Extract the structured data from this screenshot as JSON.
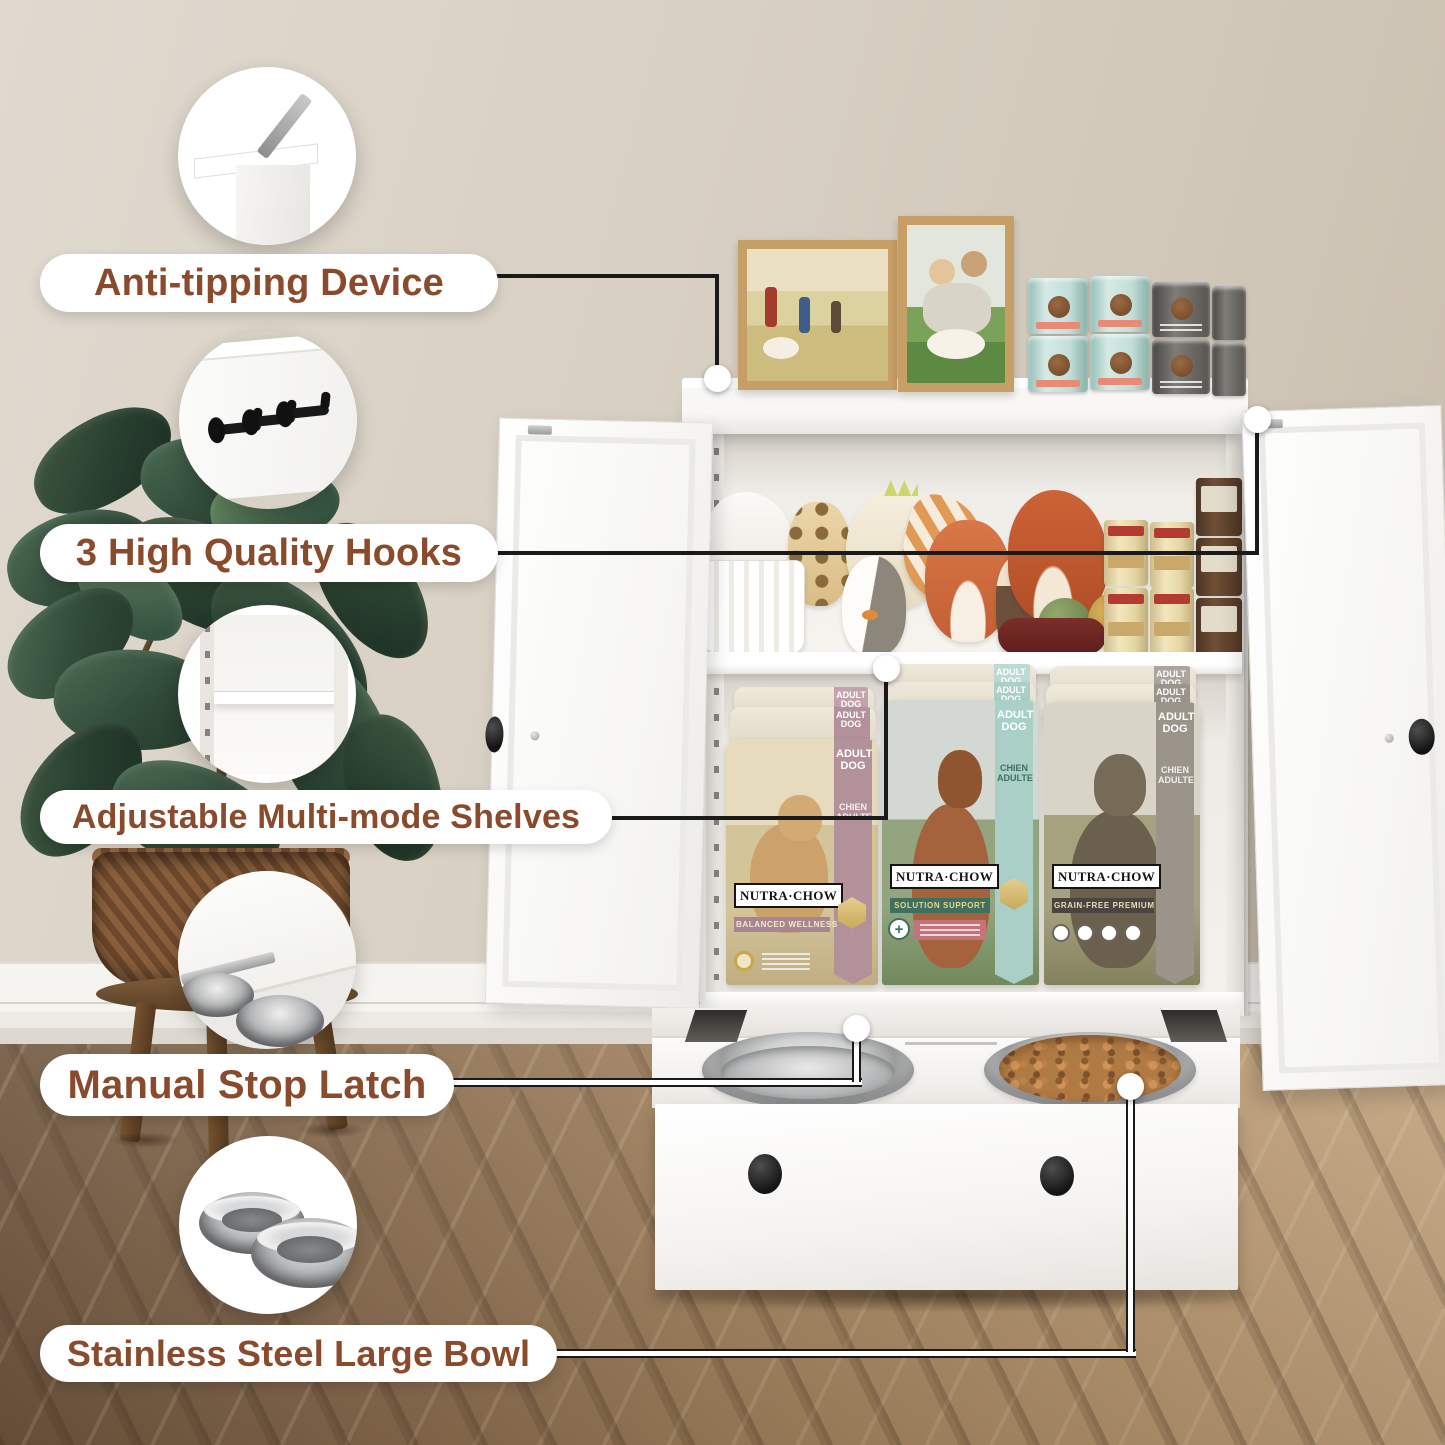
{
  "callouts": [
    {
      "label": "Anti-tipping Device",
      "icon": "anti-tip-bracket-icon"
    },
    {
      "label": "3 High Quality Hooks",
      "icon": "three-hooks-icon"
    },
    {
      "label": "Adjustable Multi-mode Shelves",
      "icon": "adjustable-shelf-icon"
    },
    {
      "label": "Manual Stop Latch",
      "icon": "manual-stop-latch-icon"
    },
    {
      "label": "Stainless Steel Large Bowl",
      "icon": "stainless-bowls-icon"
    }
  ],
  "products": {
    "bags": [
      {
        "brand": "NUTRA·CHOW",
        "line": "BALANCED WELLNESS",
        "tag_top": "ADULT DOG",
        "tag_sub": "CHIEN ADULTE",
        "banner_color": "#b3919b"
      },
      {
        "brand": "NUTRA·CHOW",
        "line": "SOLUTION SUPPORT",
        "tag_top": "ADULT DOG",
        "tag_sub": "CHIEN ADULTE",
        "banner_color": "#a9cfc7"
      },
      {
        "brand": "NUTRA·CHOW",
        "line": "GRAIN-FREE PREMIUM",
        "tag_top": "ADULT DOG",
        "tag_sub": "CHIEN ADULTE",
        "banner_color": "#9b948b"
      }
    ]
  },
  "style": {
    "label_text_color": "#8a4a2c",
    "pill_bg": "#ffffff",
    "leader_line_color": "#1a1a1a",
    "wall_color": "#d6cec1",
    "floor_color": "#a1825f",
    "cabinet_color": "#f4f2ef",
    "banner_mauve": "#b3919b",
    "banner_mint": "#a9cfc7",
    "banner_taupe": "#9b948b"
  },
  "scene": {
    "icons": [
      "photo-frame-landscape",
      "photo-frame-portrait",
      "dog-food-can-teal",
      "dog-food-can-gray",
      "plush-dinosaur",
      "storage-basket",
      "plush-giraffe",
      "plush-dino-spikes",
      "plush-penguin",
      "striped-wing-toy",
      "plush-fox",
      "plush-ferret",
      "plush-trex",
      "green-ball",
      "gold-spiky-ball",
      "red-bone-toy",
      "dog-food-can-yellow",
      "dog-food-can-brown",
      "stainless-bowl-empty",
      "stainless-bowl-kibble",
      "drawer-knob",
      "door-knob",
      "potted-plant",
      "woven-basket",
      "wood-stool"
    ]
  }
}
